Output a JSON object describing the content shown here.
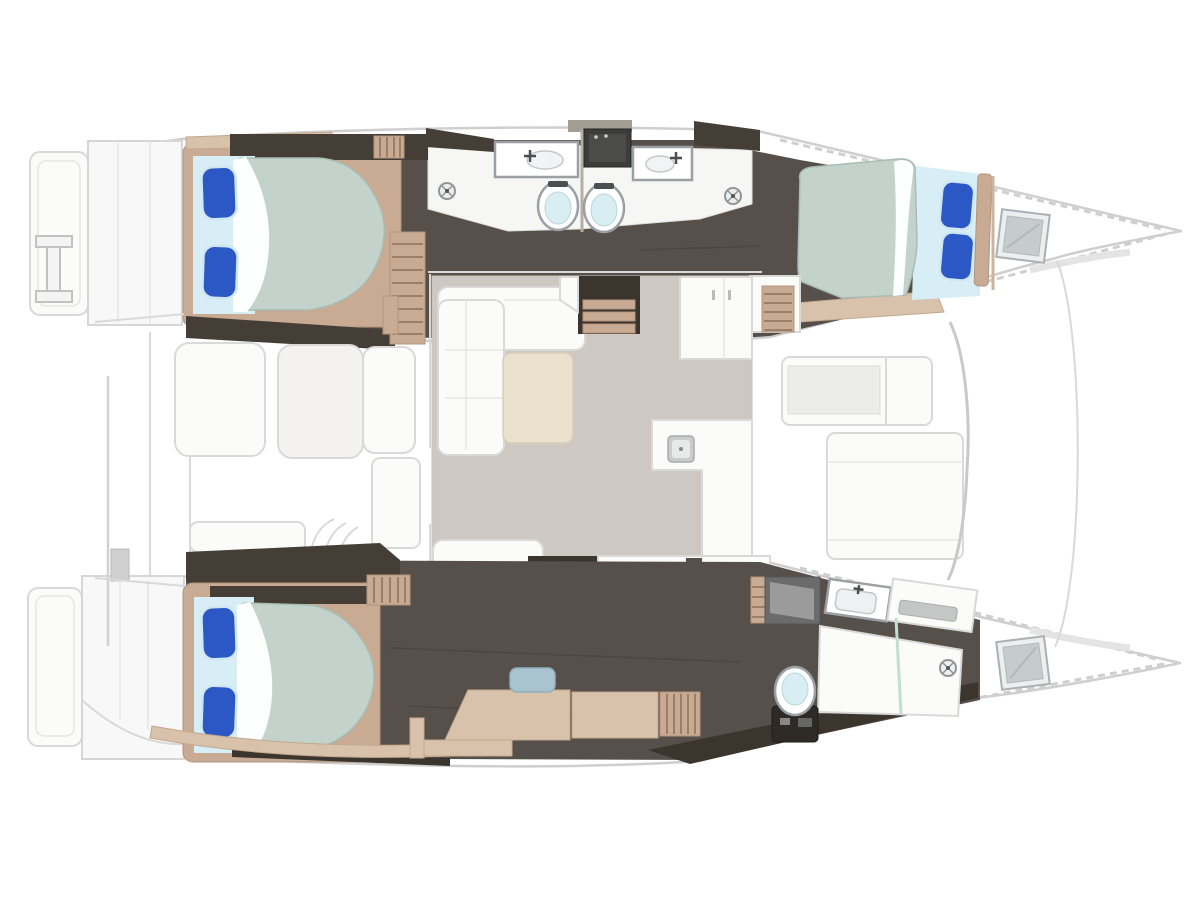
{
  "diagram": {
    "kind": "catamaran-yacht-floor-plan",
    "view": "top-down",
    "regions": [
      "transom-port",
      "transom-starboard",
      "cockpit",
      "salon",
      "galley",
      "port-aft-cabin",
      "port-aft-bathroom",
      "port-forward-bathroom",
      "port-forward-cabin",
      "owner-cabin",
      "owner-dressing-area",
      "owner-bathroom",
      "bow-port",
      "bow-starboard",
      "forepeak-locker-port",
      "forepeak-locker-starboard"
    ],
    "counts": {
      "double_beds": 3,
      "pillows": 6,
      "toilets": 3,
      "sinks": 3,
      "shower_drains": 3,
      "cooktop_burners": 4,
      "deck_hatches": 2
    },
    "features": {
      "port-aft-cabin": [
        "double-bed",
        "two-blue-pillows",
        "wardrobe"
      ],
      "port-forward-cabin": [
        "double-bed",
        "two-blue-pillows",
        "headboard"
      ],
      "port-aft-bathroom": [
        "sink-vanity",
        "toilet",
        "shower-drain"
      ],
      "port-forward-bathroom": [
        "sink-vanity",
        "toilet",
        "shower-drain"
      ],
      "salon": [
        "l-shaped-sofa",
        "coffee-table",
        "bench-seat",
        "companionway-steps"
      ],
      "galley": [
        "tall-cabinet",
        "l-counter-with-sink",
        "cooktop"
      ],
      "cockpit": [
        "three-seat-cushions",
        "bench",
        "side-panel",
        "curved-steps"
      ],
      "owner-cabin": [
        "double-bed",
        "two-blue-pillows",
        "desk",
        "stool",
        "locker"
      ],
      "owner-bathroom": [
        "vanity-sink",
        "mirror",
        "toilet",
        "walk-in-shower",
        "glass-partition",
        "shower-drain"
      ]
    }
  },
  "colors": {
    "hull-outline": "#cfcfcf",
    "panel-white": "#fbfbfa",
    "line-gray": "#d9d9d9",
    "floor-dark": "#57504a",
    "floor-darker": "#3b352e",
    "wall-dark": "#453e36",
    "wood-tan": "#c9ab93",
    "wood-light": "#d9c2ab",
    "slat-line": "#9b7f68",
    "salon-floor": "#cdc9c2",
    "bathroom-floor": "#f6f6f5",
    "table-beige": "#eae1cd",
    "duvet-sage": "#c3d3cc",
    "duvet-edge": "#a8bcb4",
    "sheet-blue": "#d8eef6",
    "pillow-blue": "#2b58c5",
    "pillow-edge": "#cfe6f4",
    "stool-blue": "#a9c3cf",
    "toilet-inner": "#d8eef2",
    "fixture-gray": "#9aa0a4",
    "glass-green": "#bfe0d5",
    "hatch-gray": "#c6cbcd",
    "dark-block": "#3c3c3a"
  }
}
